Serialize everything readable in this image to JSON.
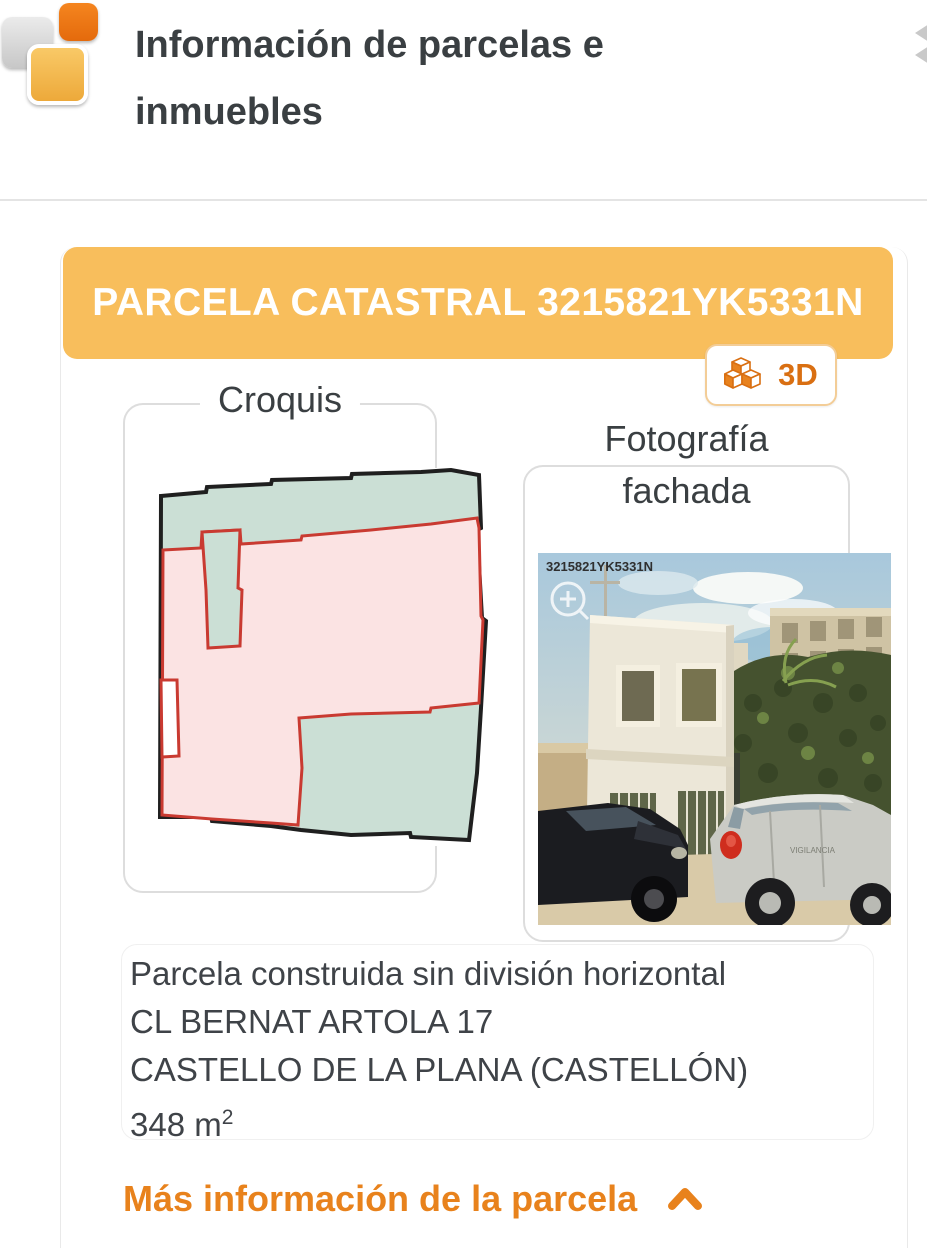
{
  "header": {
    "title_line1": "Información de parcelas e",
    "title_line2": "inmuebles"
  },
  "colors": {
    "banner_bg": "#f8be5c",
    "accent_orange": "#e8821c",
    "logo_orange": "#ee7518",
    "logo_amber": "#f3b94f",
    "logo_gray": "#d9d9d9",
    "croquis_teal": "#cbdfd5",
    "croquis_pink": "#fbe3e3",
    "croquis_red": "#c93a31"
  },
  "parcel_card": {
    "banner": {
      "title": "PARCELA CATASTRAL 3215821YK5331N"
    },
    "view3d_button": {
      "label": "3D"
    },
    "croquis": {
      "legend": "Croquis"
    },
    "photo": {
      "legend_line1": "Fotografía",
      "legend_line2": "fachada",
      "watermark": "3215821YK5331N",
      "vehicle_text": "VIGILANCIA"
    },
    "details": {
      "line1": "Parcela construida sin división horizontal",
      "line2": "CL BERNAT ARTOLA 17",
      "line3": "CASTELLO DE LA PLANA (CASTELLÓN)",
      "area_main": "348 m",
      "area_sup": "2"
    },
    "more_info": {
      "label": "Más información de la parcela"
    }
  }
}
